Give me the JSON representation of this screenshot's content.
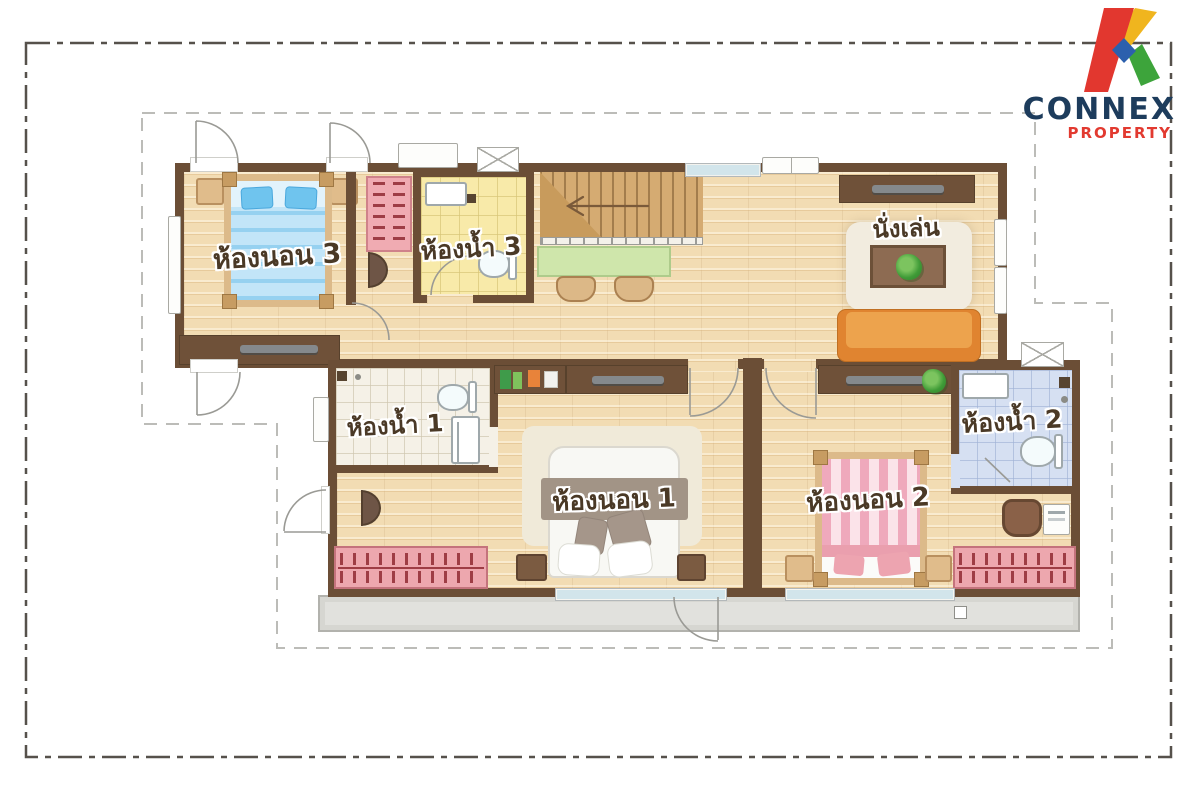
{
  "brand": {
    "name": "CONNEX",
    "tagline": "PROPERTY",
    "name_color": "#1d3c5c",
    "tagline_color": "#e23a30",
    "logo_mark_colors": {
      "red": "#e2372f",
      "yellow": "#f0b51e",
      "green": "#3da43b",
      "blue": "#2c60ad"
    }
  },
  "floor_plan": {
    "type": "second-floor residential plan",
    "rooms": [
      {
        "id": "bedroom-3",
        "label": "ห้องนอน 3"
      },
      {
        "id": "bathroom-3",
        "label": "ห้องน้ำ 3"
      },
      {
        "id": "living-corner",
        "label": "นั่งเล่น"
      },
      {
        "id": "bathroom-1",
        "label": "ห้องน้ำ 1"
      },
      {
        "id": "bedroom-1",
        "label": "ห้องนอน 1"
      },
      {
        "id": "bedroom-2",
        "label": "ห้องนอน 2"
      },
      {
        "id": "bathroom-2",
        "label": "ห้องน้ำ 2"
      }
    ],
    "colors": {
      "wall": "#6b4e36",
      "wood_floor": "#f2dcb3",
      "bath3_floor": "#f8eaa9",
      "bath1_floor": "#f5f1e7",
      "bath2_floor": "#d6e0f2",
      "balcony": "#e1e1dd",
      "bed3_blanket": "#a9d9f3",
      "bed2_blanket": "#efaebd",
      "sofa": "#e08430",
      "clothes_rack": "#eda7ae",
      "desk": "#cfe6ab",
      "outline_dash": "#bcbcb8",
      "frame_dash": "#56514b"
    }
  }
}
